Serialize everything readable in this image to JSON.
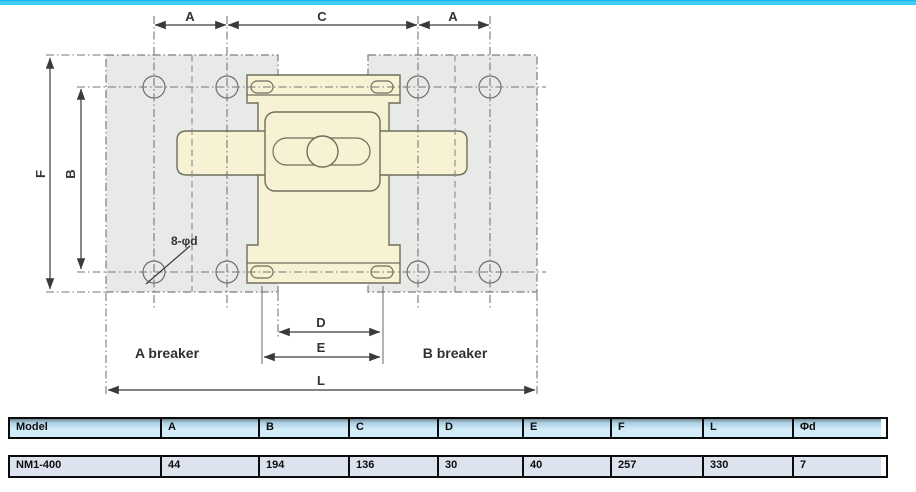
{
  "page": {
    "accent_color": "#2fc4f4"
  },
  "diagram": {
    "dims": {
      "a_left": "A",
      "c": "C",
      "a_right": "A",
      "f": "F",
      "b": "B",
      "d": "D",
      "e": "E",
      "l": "L"
    },
    "notes": {
      "holes": "8-φd",
      "breaker_a": "A breaker",
      "breaker_b": "B breaker"
    },
    "colors": {
      "plate_fill": "#e8eae7",
      "breaker_fill": "#f7f2d4",
      "outline": "#6e6e5d"
    }
  },
  "table": {
    "headers": [
      "Model",
      "A",
      "B",
      "C",
      "D",
      "E",
      "F",
      "L",
      "Φd"
    ],
    "rows": [
      [
        "NM1-400",
        "44",
        "194",
        "136",
        "30",
        "40",
        "257",
        "330",
        "7"
      ]
    ]
  }
}
